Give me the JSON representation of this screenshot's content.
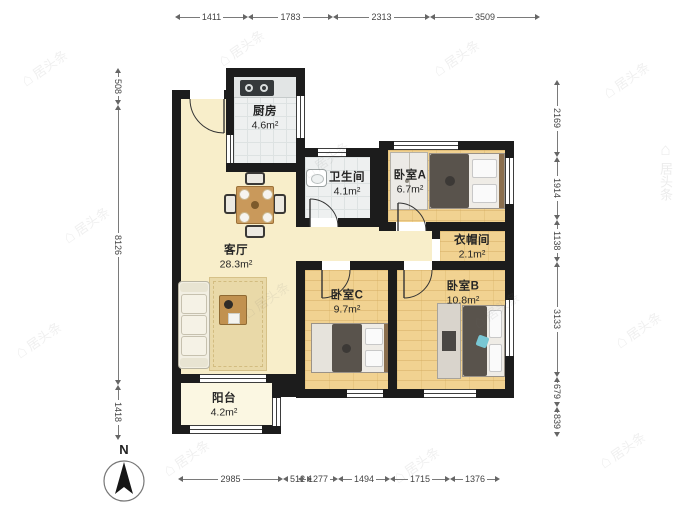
{
  "compass": {
    "label": "N"
  },
  "watermark": {
    "icon": "house-icon",
    "glyph": "⌂",
    "text": "居头条"
  },
  "rooms": [
    {
      "id": "kitchen",
      "name": "厨房",
      "area": "4.6m²"
    },
    {
      "id": "bathroom",
      "name": "卫生间",
      "area": "4.1m²"
    },
    {
      "id": "bedroom-a",
      "name": "卧室A",
      "area": "6.7m²"
    },
    {
      "id": "cloakroom",
      "name": "衣帽间",
      "area": "2.1m²"
    },
    {
      "id": "living",
      "name": "客厅",
      "area": "28.3m²"
    },
    {
      "id": "bedroom-c",
      "name": "卧室C",
      "area": "9.7m²"
    },
    {
      "id": "bedroom-b",
      "name": "卧室B",
      "area": "10.8m²"
    },
    {
      "id": "balcony",
      "name": "阳台",
      "area": "4.2m²"
    }
  ],
  "dimensions": {
    "top": [
      "1411",
      "1783",
      "2313",
      "3509"
    ],
    "left": [
      "508",
      "8126",
      "1418"
    ],
    "right": [
      "2169",
      "1914",
      "1138",
      "3133",
      "679",
      "839"
    ],
    "bottom": [
      "2985",
      "512",
      "1277",
      "1494",
      "1715",
      "1376"
    ]
  },
  "colors": {
    "wall": "#1c1c1c",
    "floor_living": "#f8eeca",
    "floor_wood": "#f1d291",
    "floor_tile": "#eef0f0",
    "floor_balcony": "#fbf7e2",
    "dim_text": "#444444"
  }
}
